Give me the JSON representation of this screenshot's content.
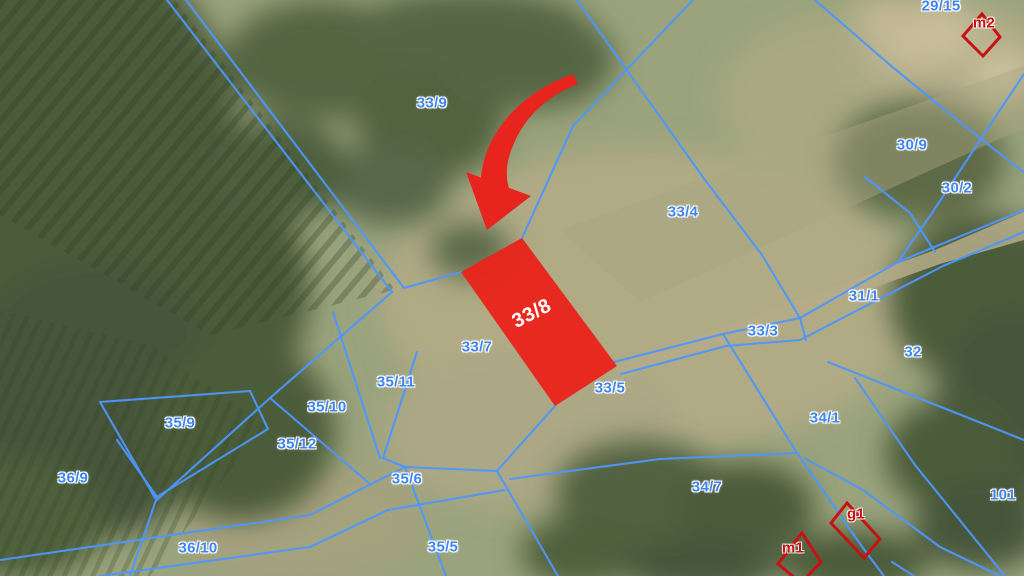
{
  "map": {
    "highlight": {
      "label": "33/8",
      "fill": "#e8251c"
    },
    "parcel_labels": [
      {
        "text": "33/9"
      },
      {
        "text": "29/15"
      },
      {
        "text": "30/9"
      },
      {
        "text": "30/2"
      },
      {
        "text": "33/4"
      },
      {
        "text": "31/1"
      },
      {
        "text": "33/3"
      },
      {
        "text": "32"
      },
      {
        "text": "33/7"
      },
      {
        "text": "33/5"
      },
      {
        "text": "35/11"
      },
      {
        "text": "35/10"
      },
      {
        "text": "35/9"
      },
      {
        "text": "34/1"
      },
      {
        "text": "35/12"
      },
      {
        "text": "36/9"
      },
      {
        "text": "35/6"
      },
      {
        "text": "34/7"
      },
      {
        "text": "101"
      },
      {
        "text": "36/10"
      },
      {
        "text": "35/5"
      }
    ],
    "annotation_labels": [
      {
        "text": "m2"
      },
      {
        "text": "g1"
      },
      {
        "text": "m1"
      }
    ],
    "colors": {
      "boundary_blue": "#4d97ff",
      "parcel_label_blue": "#3d85f2",
      "annotation_red": "#c61414",
      "highlight_red": "#e8251c",
      "arrow_red": "#e8241e"
    }
  }
}
